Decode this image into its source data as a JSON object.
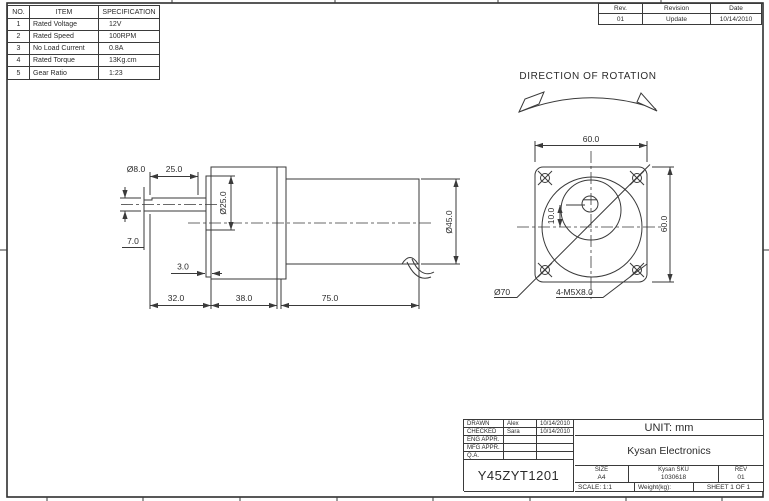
{
  "spec_table": {
    "headers": [
      "NO.",
      "ITEM",
      "SPECIFICATION"
    ],
    "rows": [
      [
        "1",
        "Rated Voltage",
        "12V"
      ],
      [
        "2",
        "Rated Speed",
        "100RPM"
      ],
      [
        "3",
        "No Load Current",
        "0.8A"
      ],
      [
        "4",
        "Rated Torque",
        "13Kg.cm"
      ],
      [
        "5",
        "Gear Ratio",
        "1:23"
      ]
    ]
  },
  "revision_table": {
    "headers": [
      "Rev.",
      "Revision",
      "Date"
    ],
    "rows": [
      [
        "01",
        "Update",
        "10/14/2010"
      ]
    ]
  },
  "rotation_note": "DIRECTION OF ROTATION",
  "side_view": {
    "dim_shaft_dia": "Ø8.0",
    "dim_shaft_len": "25.0",
    "dim_flat_len": "7.0",
    "dim_boss_dia": "Ø25.0",
    "dim_boss_len": "3.0",
    "dim_front_len": "32.0",
    "dim_gearbox_len": "38.0",
    "dim_motor_len": "75.0",
    "dim_motor_dia": "Ø45.0"
  },
  "front_view": {
    "dim_width": "60.0",
    "dim_height": "60.0",
    "dim_shaft_offset": "10.0",
    "dim_bolt_circle": "Ø70",
    "dim_mounting_holes": "4-M5X8.0"
  },
  "title_block": {
    "approvals": [
      {
        "role": "DRAWN",
        "name": "Alex",
        "date": "10/14/2010"
      },
      {
        "role": "CHECKED",
        "name": "Sara",
        "date": "10/14/2010"
      },
      {
        "role": "ENG APPR.",
        "name": "",
        "date": ""
      },
      {
        "role": "MFG APPR.",
        "name": "",
        "date": ""
      },
      {
        "role": "Q.A.",
        "name": "",
        "date": ""
      }
    ],
    "part_number": "Y45ZYT1201",
    "unit": "UNIT: mm",
    "company": "Kysan Electronics",
    "size_label": "SIZE",
    "size_value": "A4",
    "sku_label": "Kysan SKU",
    "sku_value": "1030618",
    "rev_label": "REV",
    "rev_value": "01",
    "scale": "SCALE: 1:1",
    "weight": "Weight(kg):",
    "sheet": "SHEET 1 OF 1"
  }
}
